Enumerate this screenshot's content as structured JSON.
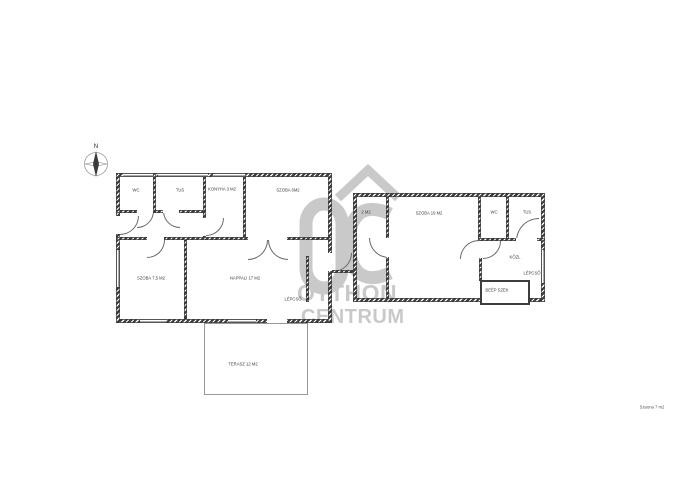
{
  "compass": {
    "north_label": "N"
  },
  "watermark": {
    "logo": "OC",
    "line1": "OTTHON",
    "line2": "CENTRUM",
    "color": "#c9c9c9"
  },
  "rooms": {
    "wc_left": "WC",
    "tus_left": "TUS",
    "konyha": "KONYHA 3 M2",
    "szoba6": "SZOBA 6M2",
    "szoba75": "SZOBA 7,5 M2",
    "nappali": "NAPPALI 17 M2",
    "lepcso_left": "LÉPCSŐ",
    "terasz": "TERASZ 12 M2",
    "eloter": "2 M2",
    "szoba19": "SZOBA 19 M2",
    "wc_right": "WC",
    "tus_right": "TUS",
    "kozl": "KÖZL",
    "lepcso_right": "LÉPCSŐ",
    "beep_szek": "BEÉP SZEK"
  },
  "footnote": "Szauna 7 m2"
}
